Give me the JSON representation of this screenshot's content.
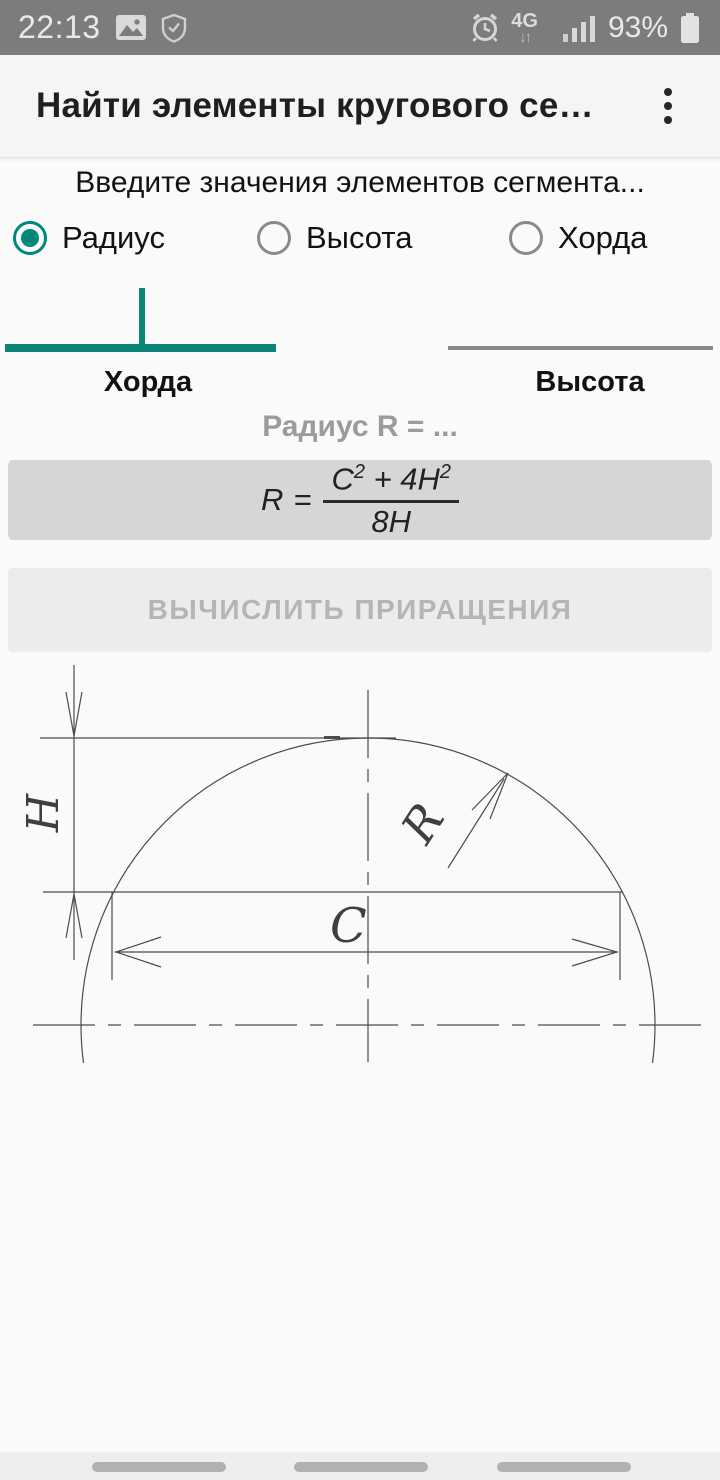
{
  "status_bar": {
    "time": "22:13",
    "network_type": "4G",
    "network_arrows": "↓↑",
    "battery_percent": "93%"
  },
  "header": {
    "title": "Найти элементы кругового се…"
  },
  "main": {
    "instruction": "Введите значения элементов сегмента...",
    "radio_group": {
      "options": [
        {
          "label": "Радиус",
          "selected": true
        },
        {
          "label": "Высота",
          "selected": false
        },
        {
          "label": "Хорда",
          "selected": false
        }
      ]
    },
    "inputs": {
      "chord": {
        "label": "Хорда",
        "value": "",
        "focused": true
      },
      "height": {
        "label": "Высота",
        "value": "",
        "focused": false
      }
    },
    "result_caption": "Радиус R = ...",
    "formula": {
      "lhs": "R",
      "equals": "=",
      "num_term1_base": "C",
      "num_term1_sup": "2",
      "num_operator": " + 4",
      "num_term2_base": "H",
      "num_term2_sup": "2",
      "denominator": "8H"
    },
    "calculate_button": {
      "label": "ВЫЧИСЛИТЬ ПРИРАЩЕНИЯ",
      "enabled": false
    }
  },
  "diagram": {
    "height_label": "H",
    "radius_label": "R",
    "chord_label": "C"
  },
  "colors": {
    "accent_teal": "#00897B",
    "focused_underline": "#0B8577",
    "status_bar_bg": "#7C7C7C",
    "formula_box_bg": "#D6D6D6",
    "button_bg": "#ECECEC",
    "disabled_text": "#B5B5B5"
  }
}
